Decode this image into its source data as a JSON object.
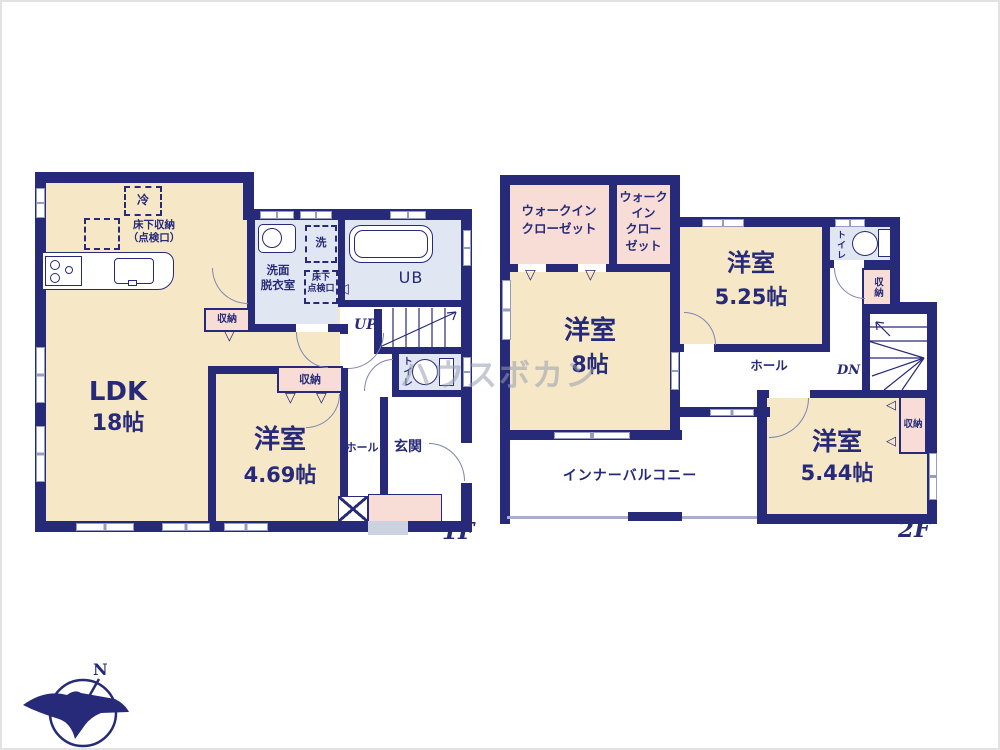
{
  "colors": {
    "wall_navy": "#262a78",
    "room_cream": "#f6e8c6",
    "wet_area_blue": "#e0e7f3",
    "closet_pink": "#f8dcd6",
    "watermark_gray": "#969cb0"
  },
  "watermark": "ハウスボカン",
  "compass": {
    "north": "N"
  },
  "marks": {
    "tri_down": "▽",
    "tri_left": "◁",
    "tri_right": "▷"
  },
  "floor1": {
    "label": "1F",
    "ldk_name": "LDK",
    "ldk_size": "18帖",
    "room_name": "洋室",
    "room_size": "4.69帖",
    "fridge": "冷",
    "underfloor_storage_l1": "床下収納",
    "underfloor_storage_l2": "（点検口）",
    "washroom_l1": "洗面",
    "washroom_l2": "脱衣室",
    "washer": "洗",
    "hatch_l1": "床下",
    "hatch_l2": "点検口",
    "bath": "UB",
    "up": "UP",
    "toilet": "トイレ",
    "hall": "ホール",
    "entrance": "玄関",
    "closet_ldk": "収納",
    "closet_room": "収納"
  },
  "floor2": {
    "label": "2F",
    "wic_l1": "ウォークイン",
    "wic_l2": "クローゼット",
    "wic2_l1": "ウォーク",
    "wic2_l2": "イン",
    "wic2_l3": "クロー",
    "wic2_l4": "ゼット",
    "room8_name": "洋室",
    "room8_size": "8帖",
    "room525_name": "洋室",
    "room525_size": "5.25帖",
    "room544_name": "洋室",
    "room544_size": "5.44帖",
    "toilet": "トイレ",
    "closet_hall": "収納",
    "closet_room": "収納",
    "dn": "DN",
    "hall": "ホール",
    "balcony": "インナーバルコニー"
  }
}
